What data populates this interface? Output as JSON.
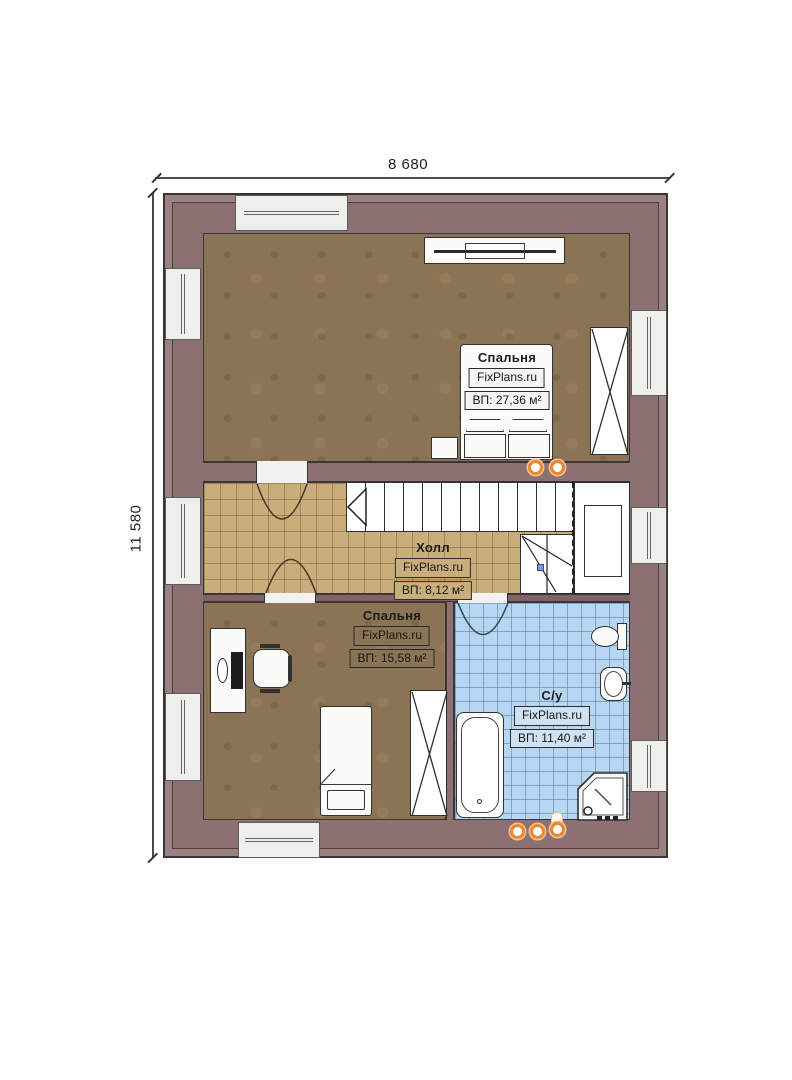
{
  "dimensions": {
    "width": "8 680",
    "height": "11 580"
  },
  "branding": "FixPlans.ru",
  "rooms": {
    "bedroom_top": {
      "name": "Спальня",
      "area": "ВП: 27,36 м²"
    },
    "hall": {
      "name": "Холл",
      "area": "ВП: 8,12 м²"
    },
    "bedroom_bottom": {
      "name": "Спальня",
      "area": "ВП: 15,58 м²"
    },
    "bathroom": {
      "name": "С/у",
      "area": "ВП: 11,40 м²"
    }
  },
  "colors": {
    "wall": "#9a8283",
    "wall_inner": "#8c7173",
    "floor_wood": "#8b7355",
    "floor_hall": "#c9ae7c",
    "floor_bath": "#b7d6f1",
    "accent_light": "#e98832",
    "paper": "#ffffff"
  }
}
